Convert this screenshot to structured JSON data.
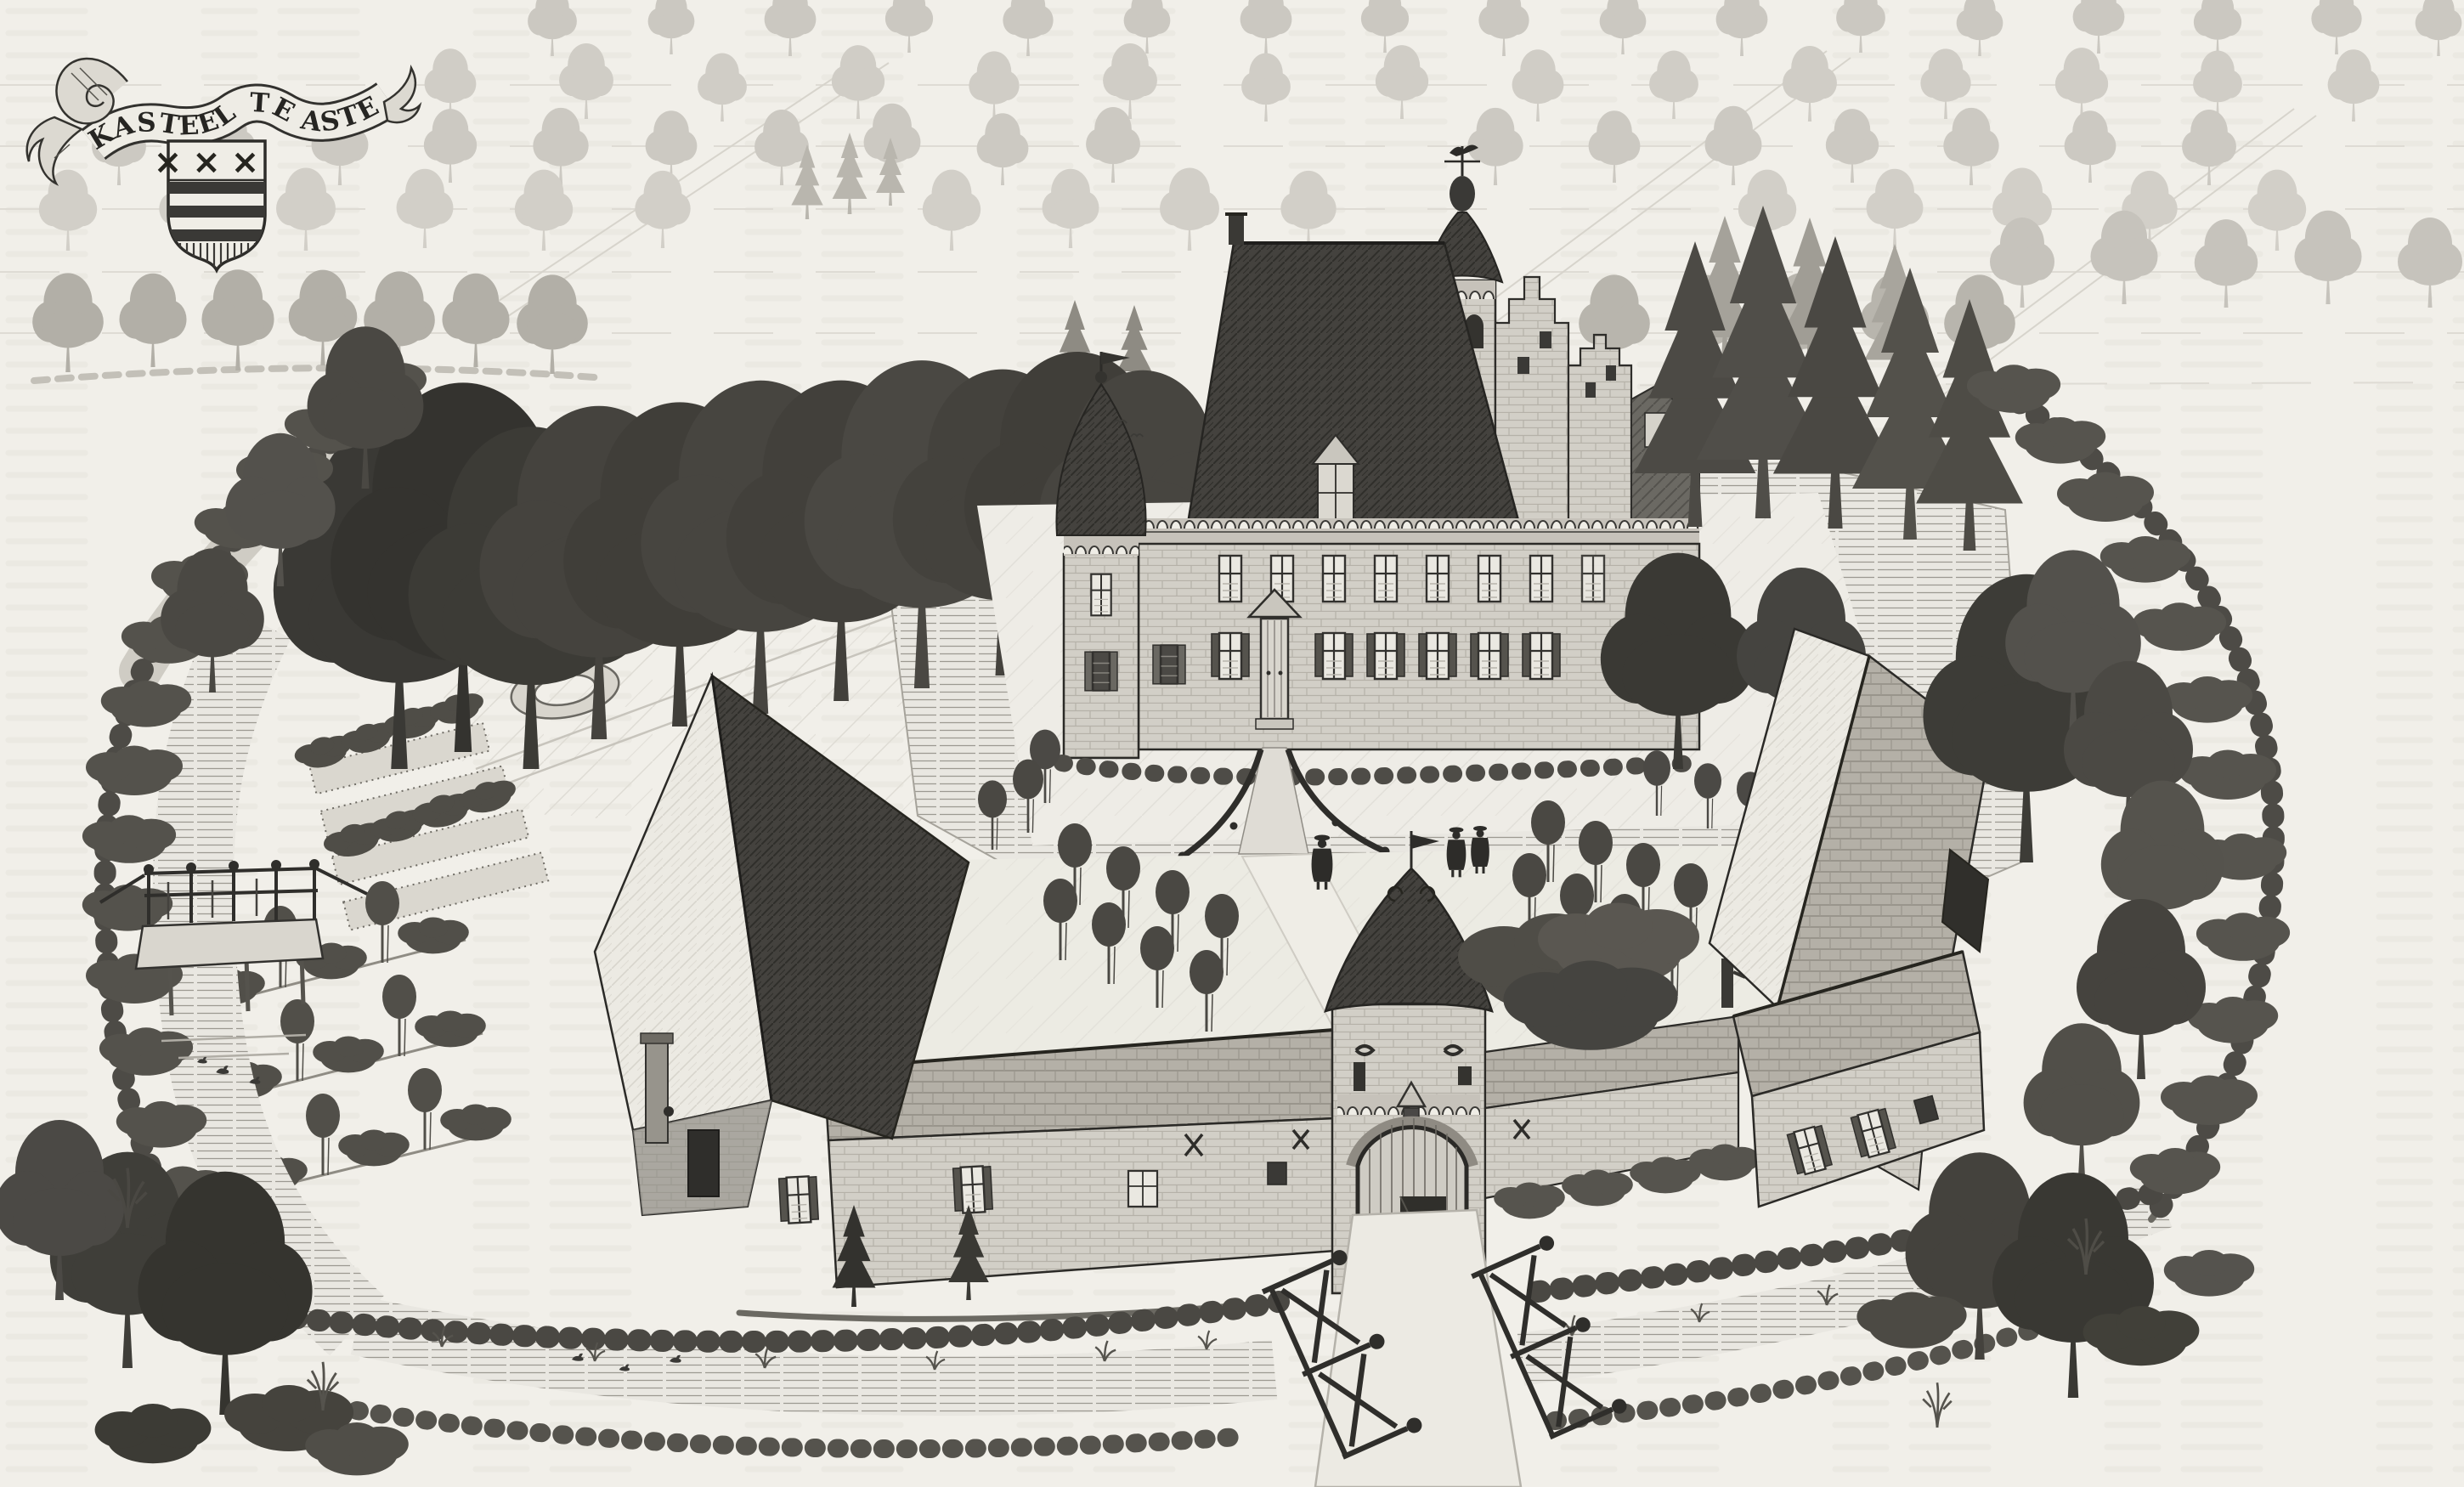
{
  "banner": {
    "title": "KASTEEL TE ASTEN"
  },
  "coat_of_arms": {
    "saltires": "×××"
  },
  "palette": {
    "paper": "#f1efe9",
    "ink_dark": "#2e2d2a",
    "ink_mid": "#55534d",
    "ink_faint": "#ccc9c2",
    "water_line": "#9c9991",
    "roof_dark": "#44423e",
    "brick": "#d2cfc7",
    "tile": "#b4b0a7",
    "thatch_light": "#eceae3",
    "foliage_dark": "#403e3a"
  },
  "scene": {
    "figure_count": 3,
    "duck_count": 6,
    "elements": [
      "title-banner",
      "coat-of-arms",
      "moated-castle",
      "onion-dome-turret",
      "bell-tower",
      "stepped-gables",
      "main-facade",
      "entrance-bridge",
      "gatehouse",
      "left-barn",
      "stable-range",
      "right-barn",
      "farm-house",
      "forecourt-orchard",
      "garden-beds",
      "ring-flowerbed",
      "oval-flowerbed",
      "moat",
      "outer-hedge",
      "footbridge",
      "entry-path",
      "strolling-figures",
      "ducks",
      "tree-avenues",
      "background-fields"
    ]
  }
}
